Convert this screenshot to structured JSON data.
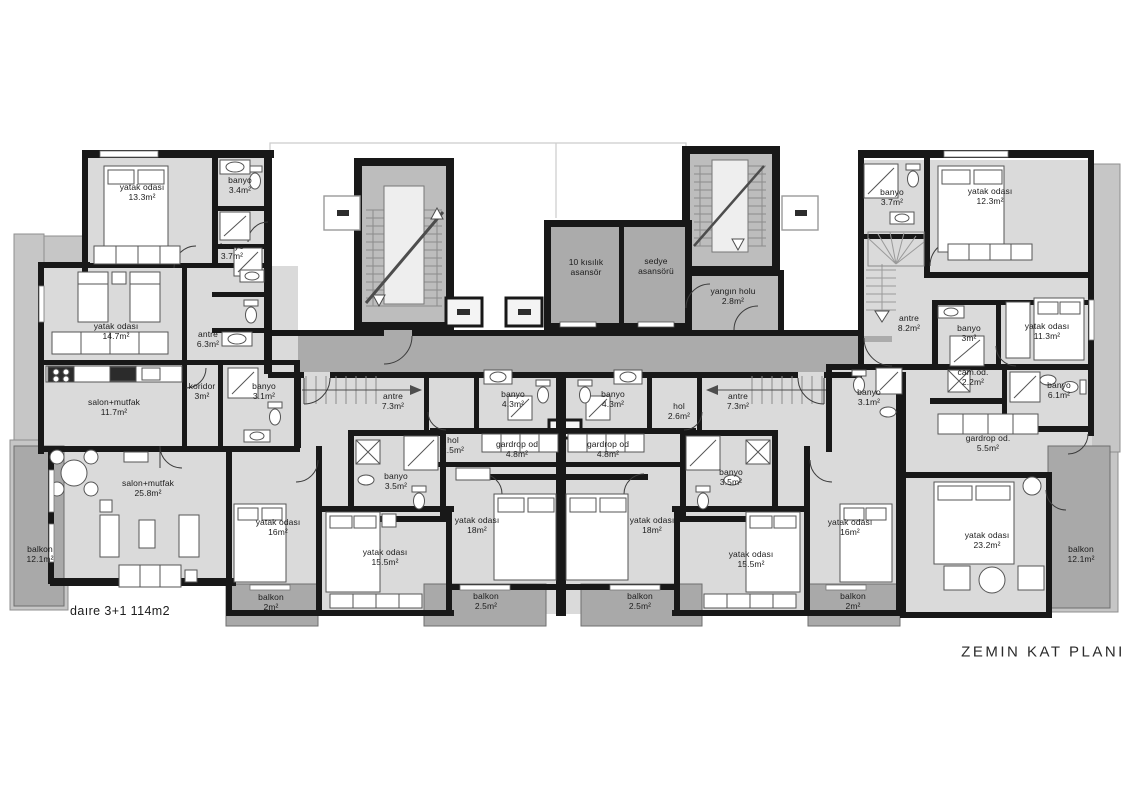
{
  "title": {
    "text": "ZEMIN  KAT PLANI"
  },
  "plan_note": {
    "text": "daıre 3+1 114m2"
  },
  "colors": {
    "wall": "#181818",
    "room_fill": "#dadada",
    "balcony_fill": "#a9a9a9",
    "terrace_fill": "#c6c6c6",
    "stair_fill": "#bdbdbd",
    "core_fill": "#ababab",
    "furniture": "#ffffff"
  },
  "labels": [
    {
      "line1": "yatak odası",
      "line2": "13.3m²",
      "x": 142,
      "y": 193
    },
    {
      "line1": "banyo",
      "line2": "3.4m²",
      "x": 240,
      "y": 186
    },
    {
      "line1": "banyo",
      "line2": "3.7m²",
      "x": 232,
      "y": 252
    },
    {
      "line1": "yatak odası",
      "line2": "14.7m²",
      "x": 116,
      "y": 332
    },
    {
      "line1": "antre",
      "line2": "6.3m²",
      "x": 208,
      "y": 340
    },
    {
      "line1": "salon+mutfak",
      "line2": "11.7m²",
      "x": 114,
      "y": 408
    },
    {
      "line1": "koridor",
      "line2": "3m²",
      "x": 202,
      "y": 392
    },
    {
      "line1": "banyo",
      "line2": "3.1m²",
      "x": 264,
      "y": 392
    },
    {
      "line1": "salon+mutfak",
      "line2": "25.8m²",
      "x": 148,
      "y": 489
    },
    {
      "line1": "balkon",
      "line2": "12.1m²",
      "x": 40,
      "y": 555
    },
    {
      "line1": "yatak odası",
      "line2": "16m²",
      "x": 278,
      "y": 528
    },
    {
      "line1": "balkon",
      "line2": "2m²",
      "x": 271,
      "y": 603
    },
    {
      "line1": "10 kısılık",
      "line2": "asansör",
      "x": 586,
      "y": 268
    },
    {
      "line1": "sedye",
      "line2": "asansörü",
      "x": 656,
      "y": 267
    },
    {
      "line1": "yangın holu",
      "line2": "2.8m²",
      "x": 733,
      "y": 297
    },
    {
      "line1": "antre",
      "line2": "7.3m²",
      "x": 393,
      "y": 402
    },
    {
      "line1": "banyo",
      "line2": "4.3m²",
      "x": 513,
      "y": 400
    },
    {
      "line1": "hol",
      "line2": "2.5m²",
      "x": 453,
      "y": 446
    },
    {
      "line1": "gardrop od",
      "line2": "4.8m²",
      "x": 517,
      "y": 450
    },
    {
      "line1": "banyo",
      "line2": "3.5m²",
      "x": 396,
      "y": 482
    },
    {
      "line1": "yatak odası",
      "line2": "15.5m²",
      "x": 385,
      "y": 558
    },
    {
      "line1": "yatak odası",
      "line2": "18m²",
      "x": 477,
      "y": 526
    },
    {
      "line1": "balkon",
      "line2": "2.5m²",
      "x": 486,
      "y": 602
    },
    {
      "line1": "banyo",
      "line2": "4.3m²",
      "x": 613,
      "y": 400
    },
    {
      "line1": "antre",
      "line2": "7.3m²",
      "x": 738,
      "y": 402
    },
    {
      "line1": "hol",
      "line2": "2.6m²",
      "x": 679,
      "y": 412
    },
    {
      "line1": "gardrop od",
      "line2": "4.8m²",
      "x": 608,
      "y": 450
    },
    {
      "line1": "banyo",
      "line2": "3.5m²",
      "x": 731,
      "y": 478
    },
    {
      "line1": "yatak odası",
      "line2": "18m²",
      "x": 652,
      "y": 526
    },
    {
      "line1": "yatak odası",
      "line2": "15.5m²",
      "x": 751,
      "y": 560
    },
    {
      "line1": "balkon",
      "line2": "2.5m²",
      "x": 640,
      "y": 602
    },
    {
      "line1": "balkon",
      "line2": "2m²",
      "x": 853,
      "y": 602
    },
    {
      "line1": "banyo",
      "line2": "3.1m²",
      "x": 869,
      "y": 398
    },
    {
      "line1": "yatak odası",
      "line2": "16m²",
      "x": 850,
      "y": 528
    },
    {
      "line1": "banyo",
      "line2": "3.7m²",
      "x": 892,
      "y": 198
    },
    {
      "line1": "yatak odası",
      "line2": "12.3m²",
      "x": 990,
      "y": 197
    },
    {
      "line1": "antre",
      "line2": "8.2m²",
      "x": 909,
      "y": 324
    },
    {
      "line1": "banyo",
      "line2": "3m²",
      "x": 969,
      "y": 334
    },
    {
      "line1": "yatak odası",
      "line2": "11.3m²",
      "x": 1047,
      "y": 332
    },
    {
      "line1": "cam.od.",
      "line2": "2.2m²",
      "x": 973,
      "y": 378
    },
    {
      "line1": "banyo",
      "line2": "6.1m²",
      "x": 1059,
      "y": 391
    },
    {
      "line1": "gardrop od.",
      "line2": "5.5m²",
      "x": 988,
      "y": 444
    },
    {
      "line1": "yatak odası",
      "line2": "23.2m²",
      "x": 987,
      "y": 541
    },
    {
      "line1": "balkon",
      "line2": "12.1m²",
      "x": 1081,
      "y": 555
    }
  ]
}
